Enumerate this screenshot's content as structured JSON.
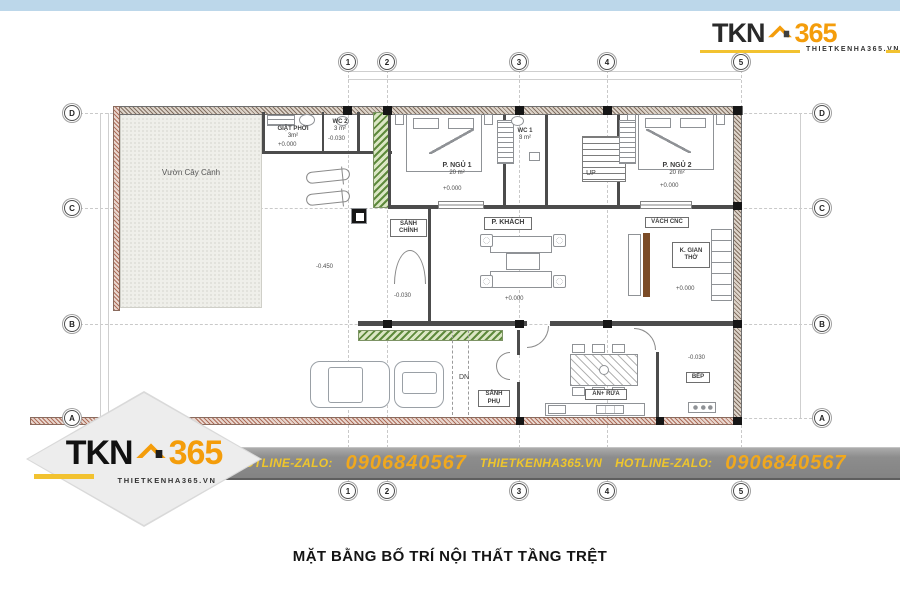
{
  "title": {
    "text": "MẶT BẰNG BỐ TRÍ NỘI THẤT TẦNG TRỆT"
  },
  "logo": {
    "tkn": "TKN",
    "n365": "365",
    "domain": "THIETKENHA365.VN"
  },
  "banner": {
    "hotline": "HOTLINE-ZALO:",
    "phone": "0906840567",
    "site": "THIETKENHA365.VN",
    "hotline2": "HOTLINE-ZALO:",
    "phone2": "0906840567"
  },
  "colors": {
    "accent_orange": "#F49D0B",
    "banner_gold": "#EFC62C",
    "topbar_blue": "#BCD7EA",
    "banner_gray": "#8D8D8D"
  },
  "grid": {
    "cols": [
      "1",
      "2",
      "3",
      "4",
      "5"
    ],
    "rows": [
      "D",
      "C",
      "B",
      "A"
    ]
  },
  "rooms": {
    "garden": "Vườn Cây Cảnh",
    "laundry": "GIẶT PHƠI",
    "laundry_area": "3m²",
    "laundry_elev": "+0.000",
    "wc2": "WC 2",
    "wc2_area": "3 m²",
    "wc2_elev": "-0.030",
    "bed1": "P. NGỦ 1",
    "bed1_area": "20 m²",
    "bed1_elev": "+0.000",
    "wc1": "WC 1",
    "wc1_area": "3 m²",
    "up": "UP",
    "dn": "DN",
    "bed2": "P. NGỦ 2",
    "bed2_area": "20 m²",
    "bed2_elev": "+0.000",
    "main_hall": "SẢNH CHÍNH",
    "main_hall_elev": "-0.030",
    "living": "P. KHÁCH",
    "living_elev": "+0.000",
    "cnc": "VÁCH CNC",
    "worship": "K. GIAN THỜ",
    "worship_elev": "+0.000",
    "yard_elev": "-0.450",
    "side_hall": "SẢNH PHỤ",
    "dining": "ĂN+ RỬA",
    "kitchen": "BẾP",
    "kitchen_elev": "-0.030"
  }
}
